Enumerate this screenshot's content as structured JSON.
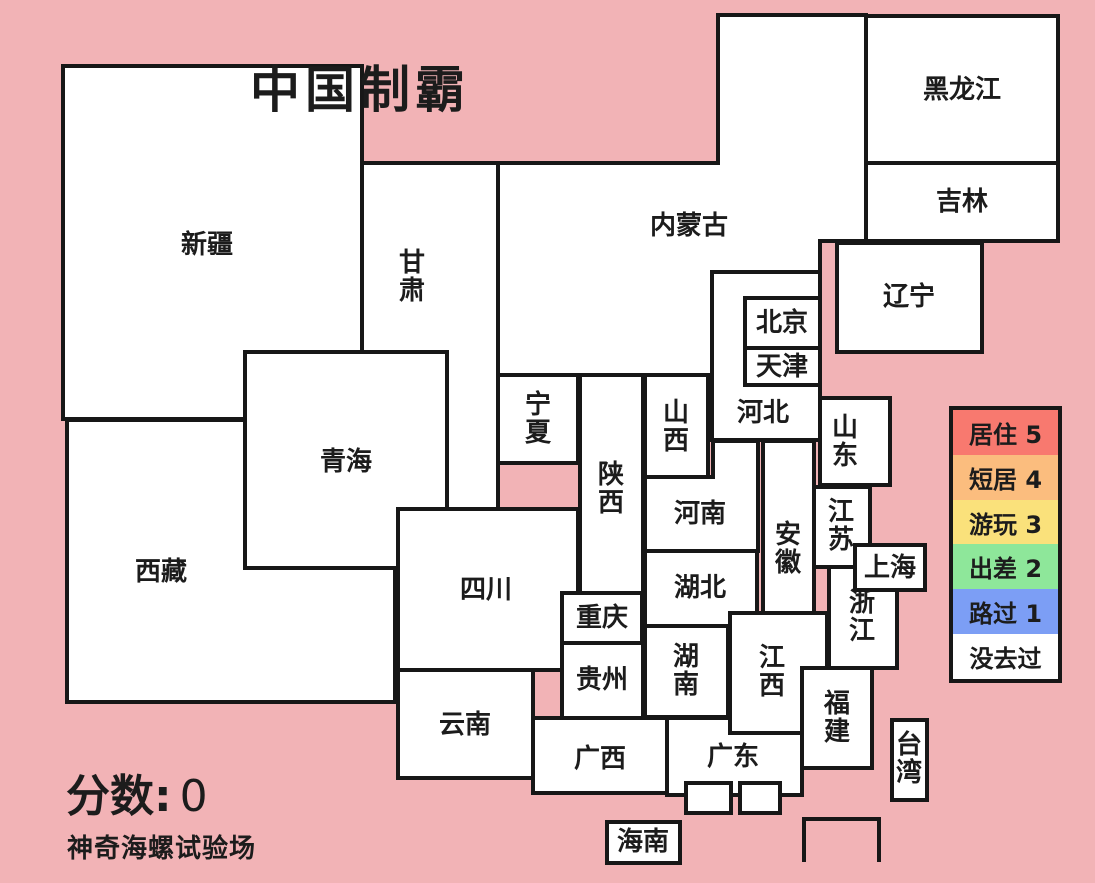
{
  "title": "中国制霸",
  "subtitle": "神奇海螺试验场",
  "score": {
    "label": "分数:",
    "value": "0"
  },
  "colors": {
    "background": "#F2B3B6",
    "border": "#171717",
    "province_fill": "#FFFFFF",
    "label_text": "#1c1c1c"
  },
  "legend": {
    "box": {
      "left": 949,
      "top": 406,
      "width": 113,
      "height": 277
    },
    "items": [
      {
        "label": "居住 5",
        "color": "#F8796F"
      },
      {
        "label": "短居 4",
        "color": "#FBBD7E"
      },
      {
        "label": "游玩 3",
        "color": "#FAE17B"
      },
      {
        "label": "出差 2",
        "color": "#8EE79A"
      },
      {
        "label": "路过 1",
        "color": "#7C9EF5"
      },
      {
        "label": "没去过",
        "color": "#FFFFFF"
      }
    ]
  },
  "map": {
    "stroke_width": 4,
    "label_font_size": 26,
    "vertical_char_step": 28,
    "provinces": [
      {
        "id": "gansu",
        "label": "甘肃",
        "vertical": true,
        "rect": [
          362,
          163,
          136,
          346
        ],
        "label_pos": [
          412,
          277
        ]
      },
      {
        "id": "xizang",
        "label": "西藏",
        "vertical": false,
        "rect": [
          67,
          420,
          328,
          282
        ],
        "label_pos": [
          161,
          572
        ]
      },
      {
        "id": "xinjiang",
        "label": "新疆",
        "vertical": false,
        "rect": [
          63,
          66,
          299,
          353
        ],
        "label_pos": [
          207,
          245
        ]
      },
      {
        "id": "qinghai",
        "label": "青海",
        "vertical": false,
        "rect": [
          245,
          352,
          202,
          216
        ],
        "label_pos": [
          346,
          462
        ]
      },
      {
        "id": "neimenggu",
        "label": "内蒙古",
        "vertical": false,
        "polygon": [
          [
            498,
            163
          ],
          [
            718,
            163
          ],
          [
            718,
            15
          ],
          [
            866,
            15
          ],
          [
            866,
            241
          ],
          [
            820,
            241
          ],
          [
            820,
            272
          ],
          [
            712,
            272
          ],
          [
            712,
            375
          ],
          [
            498,
            375
          ]
        ],
        "label_pos": [
          689,
          226
        ]
      },
      {
        "id": "ningxia",
        "label": "宁夏",
        "vertical": true,
        "rect": [
          498,
          375,
          80,
          88
        ],
        "label_pos": [
          538,
          419
        ]
      },
      {
        "id": "shaanxi",
        "label": "陕西",
        "vertical": true,
        "rect": [
          580,
          375,
          63,
          218
        ],
        "label_pos": [
          611,
          489
        ]
      },
      {
        "id": "shanxi",
        "label": "山西",
        "vertical": true,
        "rect": [
          645,
          375,
          63,
          102
        ],
        "label_pos": [
          676,
          427
        ]
      },
      {
        "id": "sichuan",
        "label": "四川",
        "vertical": false,
        "rect": [
          398,
          509,
          180,
          161
        ],
        "label_pos": [
          486,
          590
        ]
      },
      {
        "id": "henan",
        "label": "河南",
        "vertical": false,
        "polygon": [
          [
            645,
            477
          ],
          [
            713,
            477
          ],
          [
            713,
            441
          ],
          [
            758,
            441
          ],
          [
            758,
            551
          ],
          [
            645,
            551
          ]
        ],
        "label_pos": [
          700,
          514
        ]
      },
      {
        "id": "hubei",
        "label": "湖北",
        "vertical": false,
        "rect": [
          645,
          551,
          112,
          75
        ],
        "label_pos": [
          700,
          588
        ]
      },
      {
        "id": "chongqing",
        "label": "重庆",
        "vertical": false,
        "rect": [
          562,
          593,
          80,
          50
        ],
        "label_pos": [
          602,
          618
        ]
      },
      {
        "id": "guizhou",
        "label": "贵州",
        "vertical": false,
        "rect": [
          562,
          643,
          81,
          75
        ],
        "label_pos": [
          602,
          680
        ]
      },
      {
        "id": "yunnan",
        "label": "云南",
        "vertical": false,
        "rect": [
          398,
          670,
          135,
          108
        ],
        "label_pos": [
          465,
          725
        ]
      },
      {
        "id": "guangxi",
        "label": "广西",
        "vertical": false,
        "rect": [
          533,
          718,
          135,
          75
        ],
        "label_pos": [
          600,
          759
        ]
      },
      {
        "id": "guangdong",
        "label": "广东",
        "vertical": false,
        "rect": [
          667,
          718,
          135,
          77
        ],
        "label_pos": [
          733,
          757
        ]
      },
      {
        "id": "hebei",
        "label": "河北",
        "vertical": false,
        "rect": [
          712,
          272,
          108,
          168
        ],
        "label_pos": [
          763,
          413
        ]
      },
      {
        "id": "beijing",
        "label": "北京",
        "vertical": false,
        "rect": [
          745,
          298,
          75,
          50
        ],
        "label_pos": [
          782,
          323
        ]
      },
      {
        "id": "tianjin",
        "label": "天津",
        "vertical": false,
        "rect": [
          745,
          348,
          75,
          37
        ],
        "label_pos": [
          782,
          367
        ]
      },
      {
        "id": "shandong",
        "label": "山东",
        "vertical": true,
        "rect": [
          820,
          398,
          70,
          87
        ],
        "label_pos": [
          845,
          442
        ]
      },
      {
        "id": "anhui",
        "label": "安徽",
        "vertical": true,
        "rect": [
          763,
          441,
          51,
          172
        ],
        "label_pos": [
          788,
          549
        ]
      },
      {
        "id": "jiangsu",
        "label": "江苏",
        "vertical": true,
        "rect": [
          814,
          487,
          56,
          80
        ],
        "label_pos": [
          841,
          526
        ]
      },
      {
        "id": "jiangxi",
        "label": "江西",
        "vertical": true,
        "rect": [
          730,
          613,
          97,
          120
        ],
        "label_pos": [
          772,
          672
        ]
      },
      {
        "id": "hunan",
        "label": "湖南",
        "vertical": true,
        "rect": [
          645,
          626,
          83,
          91
        ],
        "label_pos": [
          686,
          671
        ]
      },
      {
        "id": "zhejiang",
        "label": "浙江",
        "vertical": true,
        "rect": [
          829,
          567,
          68,
          101
        ],
        "label_pos": [
          862,
          617
        ]
      },
      {
        "id": "shanghai",
        "label": "上海",
        "vertical": false,
        "rect": [
          855,
          545,
          70,
          45
        ],
        "label_pos": [
          890,
          568
        ]
      },
      {
        "id": "fujian",
        "label": "福建",
        "vertical": true,
        "rect": [
          802,
          668,
          70,
          100
        ],
        "label_pos": [
          837,
          718
        ]
      },
      {
        "id": "heilongjiang",
        "label": "黑龙江",
        "vertical": false,
        "rect": [
          866,
          16,
          192,
          147
        ],
        "label_pos": [
          962,
          90
        ]
      },
      {
        "id": "jilin",
        "label": "吉林",
        "vertical": false,
        "rect": [
          866,
          163,
          192,
          78
        ],
        "label_pos": [
          962,
          202
        ]
      },
      {
        "id": "liaoning",
        "label": "辽宁",
        "vertical": false,
        "rect": [
          837,
          243,
          145,
          109
        ],
        "label_pos": [
          909,
          297
        ]
      },
      {
        "id": "unlabeled-box-west",
        "label": "",
        "vertical": false,
        "rect": [
          686,
          783,
          45,
          30
        ],
        "label_pos": [
          708,
          798
        ]
      },
      {
        "id": "unlabeled-box-east",
        "label": "",
        "vertical": false,
        "rect": [
          740,
          783,
          40,
          30
        ],
        "label_pos": [
          760,
          798
        ]
      },
      {
        "id": "hainan",
        "label": "海南",
        "vertical": false,
        "rect": [
          607,
          822,
          73,
          41
        ],
        "label_pos": [
          643,
          842
        ]
      },
      {
        "id": "taiwan",
        "label": "台湾",
        "vertical": true,
        "rect": [
          892,
          720,
          35,
          80
        ],
        "label_pos": [
          909,
          759
        ]
      }
    ],
    "sea_outline": {
      "id": "sea-box-outline",
      "path": "M804,862 L804,819 L879,819 L879,862"
    }
  }
}
